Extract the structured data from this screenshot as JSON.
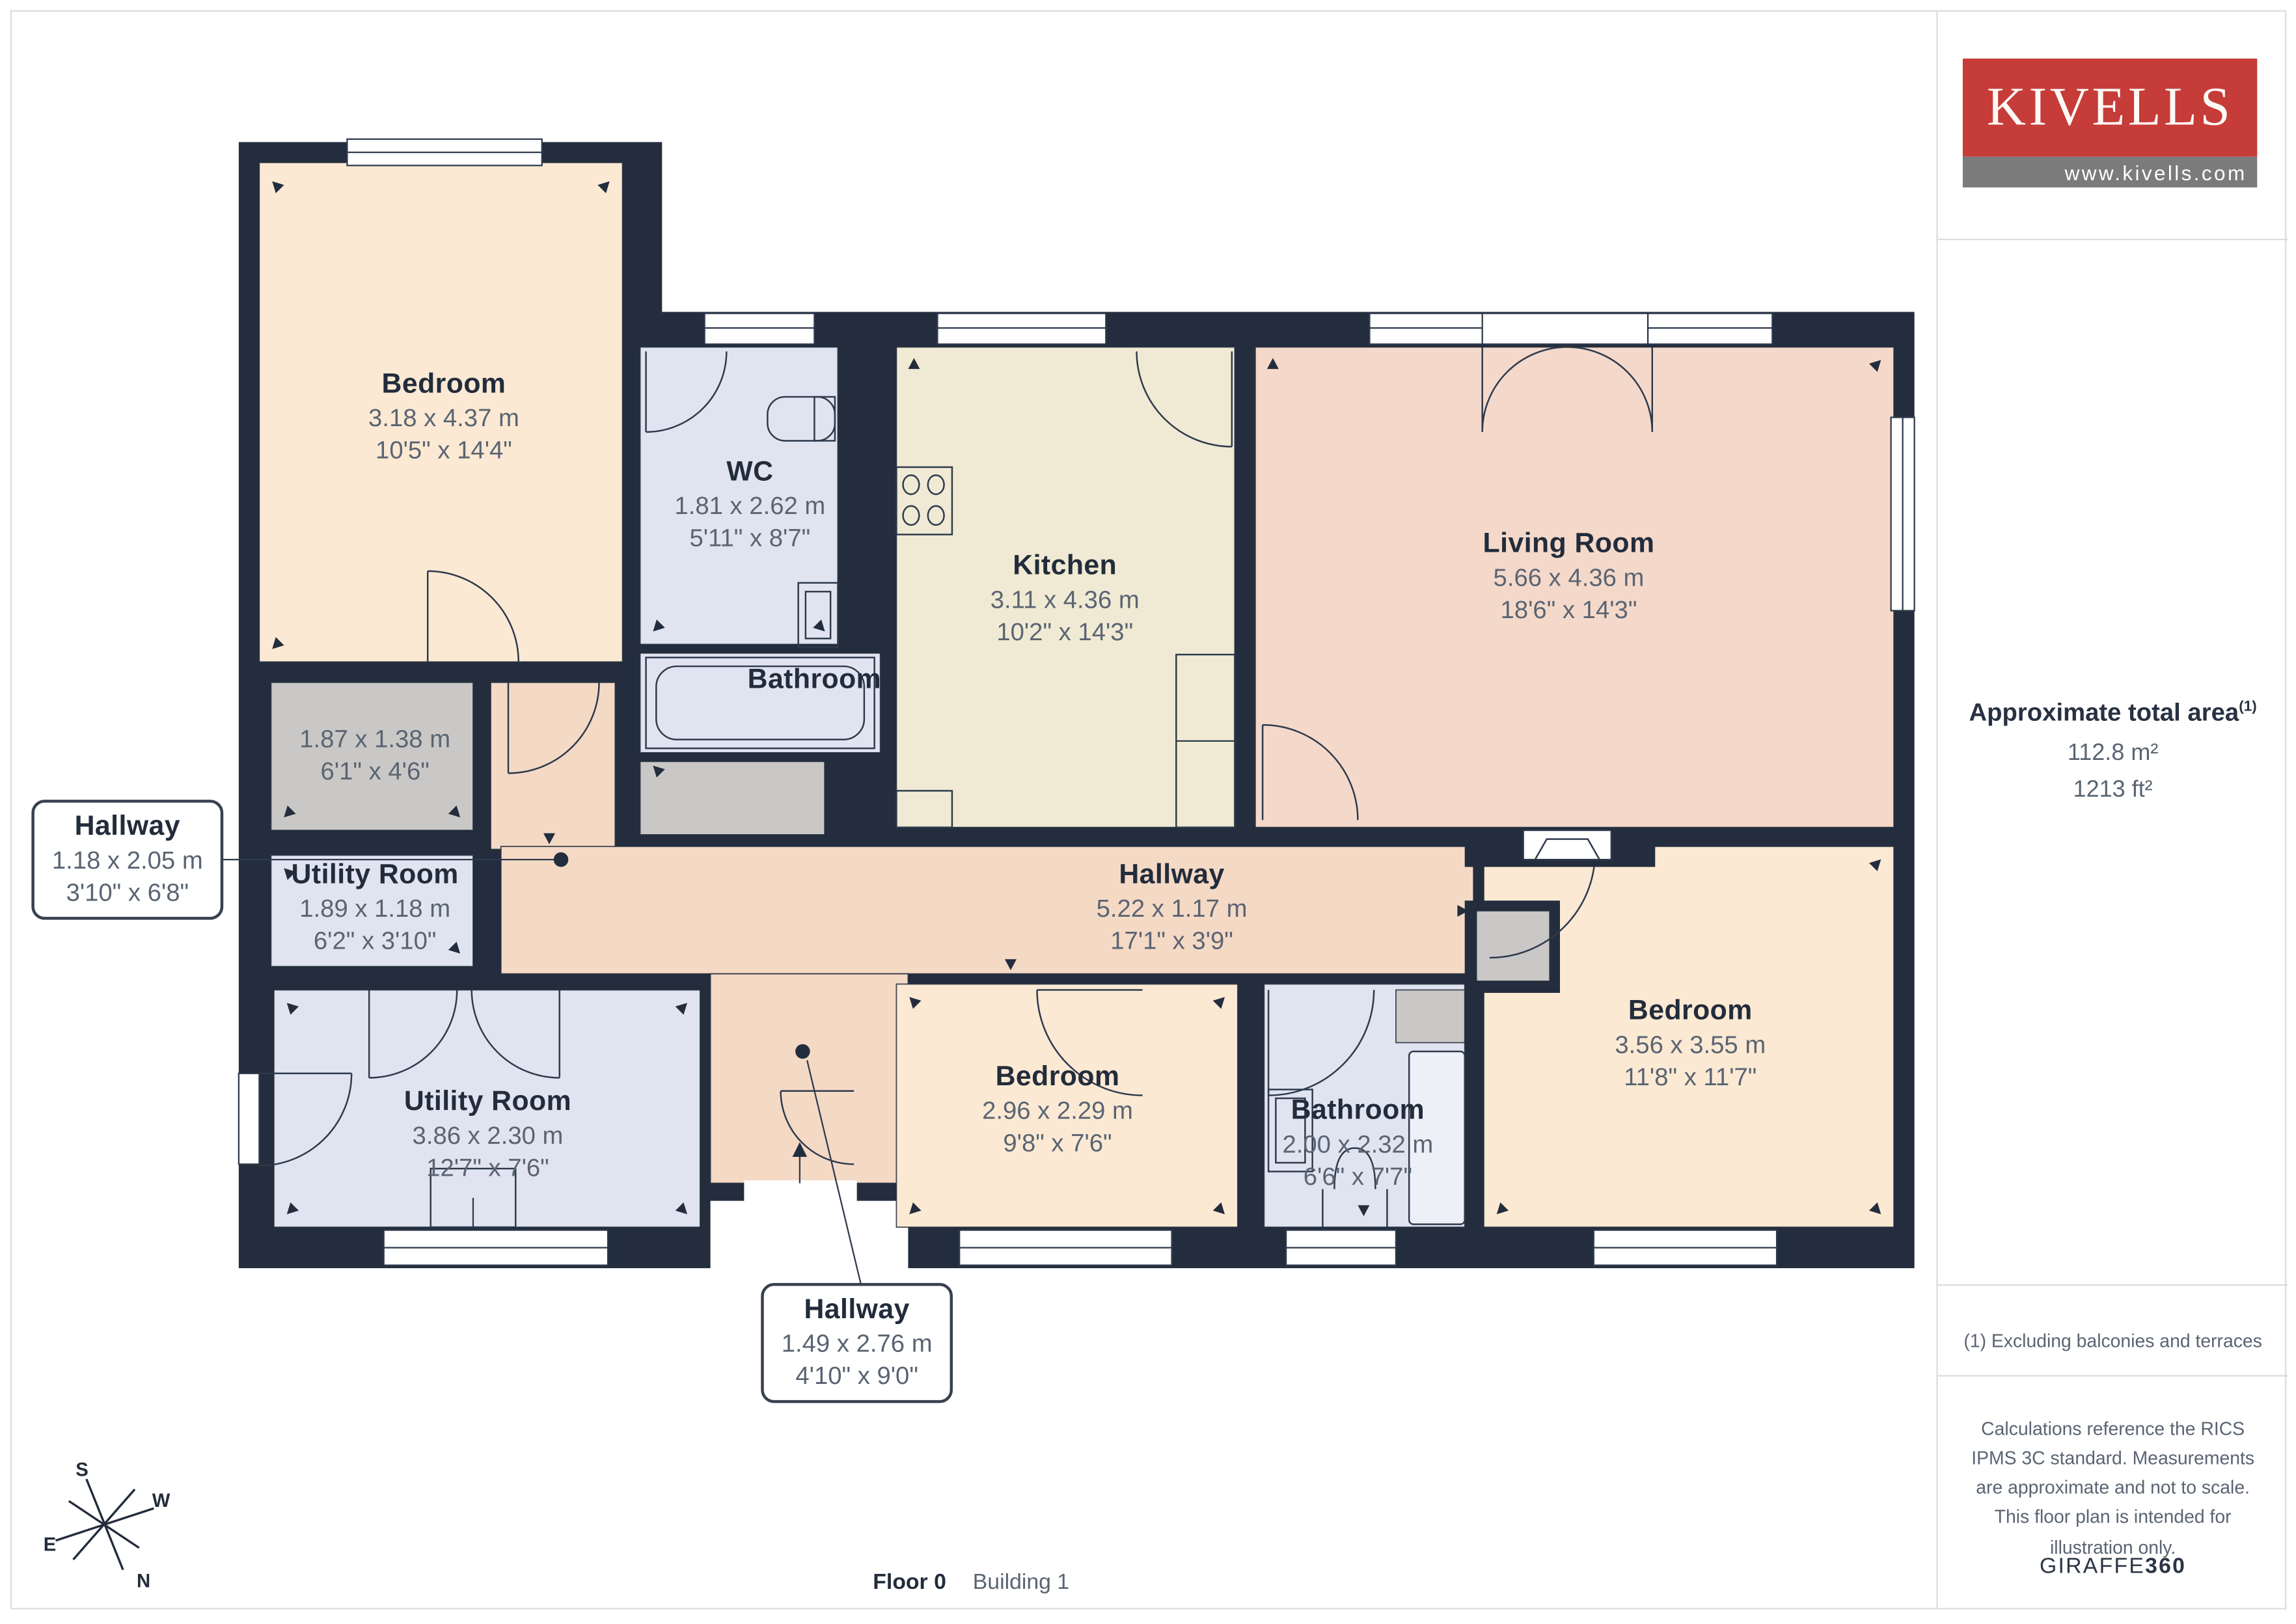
{
  "sidebar": {
    "brand": "KIVELLS",
    "url": "www.kivells.com",
    "area_heading": "Approximate total area",
    "area_ref": "(1)",
    "area_m2": "112.8 m²",
    "area_ft2": "1213 ft²",
    "note1": "(1) Excluding balconies and terraces",
    "note2": "Calculations reference the RICS IPMS 3C standard. Measurements are approximate and not to scale. This floor plan is intended for illustration only.",
    "brand2_regular": "GIRAFFE",
    "brand2_bold": "360"
  },
  "footer": {
    "floor": "Floor 0",
    "building": "Building 1"
  },
  "compass": {
    "s": "S",
    "w": "W",
    "e": "E",
    "n": "N"
  },
  "rooms": [
    {
      "name": "Bedroom",
      "metric": "3.18 x 4.37 m",
      "imperial": "10'5\" x 14'4\""
    },
    {
      "name": "WC",
      "metric": "1.81 x 2.62 m",
      "imperial": "5'11\" x 8'7\""
    },
    {
      "name": "Kitchen",
      "metric": "3.11 x 4.36 m",
      "imperial": "10'2\" x 14'3\""
    },
    {
      "name": "Living Room",
      "metric": "5.66 x 4.36 m",
      "imperial": "18'6\" x 14'3\""
    },
    {
      "name": "Bathroom"
    },
    {
      "metric": "1.87 x 1.38 m",
      "imperial": "6'1\" x 4'6\""
    },
    {
      "name": "Utility Room",
      "metric": "1.89 x 1.18 m",
      "imperial": "6'2\" x 3'10\""
    },
    {
      "name": "Hallway",
      "metric": "5.22 x 1.17 m",
      "imperial": "17'1\" x 3'9\""
    },
    {
      "name": "Utility Room",
      "metric": "3.86 x 2.30 m",
      "imperial": "12'7\" x 7'6\""
    },
    {
      "name": "Bedroom",
      "metric": "2.96 x 2.29 m",
      "imperial": "9'8\" x 7'6\""
    },
    {
      "name": "Bathroom",
      "metric": "2.00 x 2.32 m",
      "imperial": "6'6\" x 7'7\""
    },
    {
      "name": "Bedroom",
      "metric": "3.56 x 3.55 m",
      "imperial": "11'8\" x 11'7\""
    }
  ],
  "callouts": {
    "hallway_left": {
      "name": "Hallway",
      "metric": "1.18 x 2.05 m",
      "imperial": "3'10\" x 6'8\""
    },
    "hallway_bottom": {
      "name": "Hallway",
      "metric": "1.49 x 2.76 m",
      "imperial": "4'10\" x 9'0\""
    }
  },
  "colors": {
    "wall": "#232d3d",
    "ink": "#222c3b",
    "dim": "#5a6472",
    "peach": "#fbe9d4",
    "salmon": "#f4d9c5",
    "living": "#f4d9ca",
    "kitchen": "#f0ead4",
    "blue": "#e0e4f1",
    "gray": "#c9c8c6",
    "red": "#c63c38",
    "graybar": "#7b7b7b",
    "line": "#dcdcdc"
  }
}
